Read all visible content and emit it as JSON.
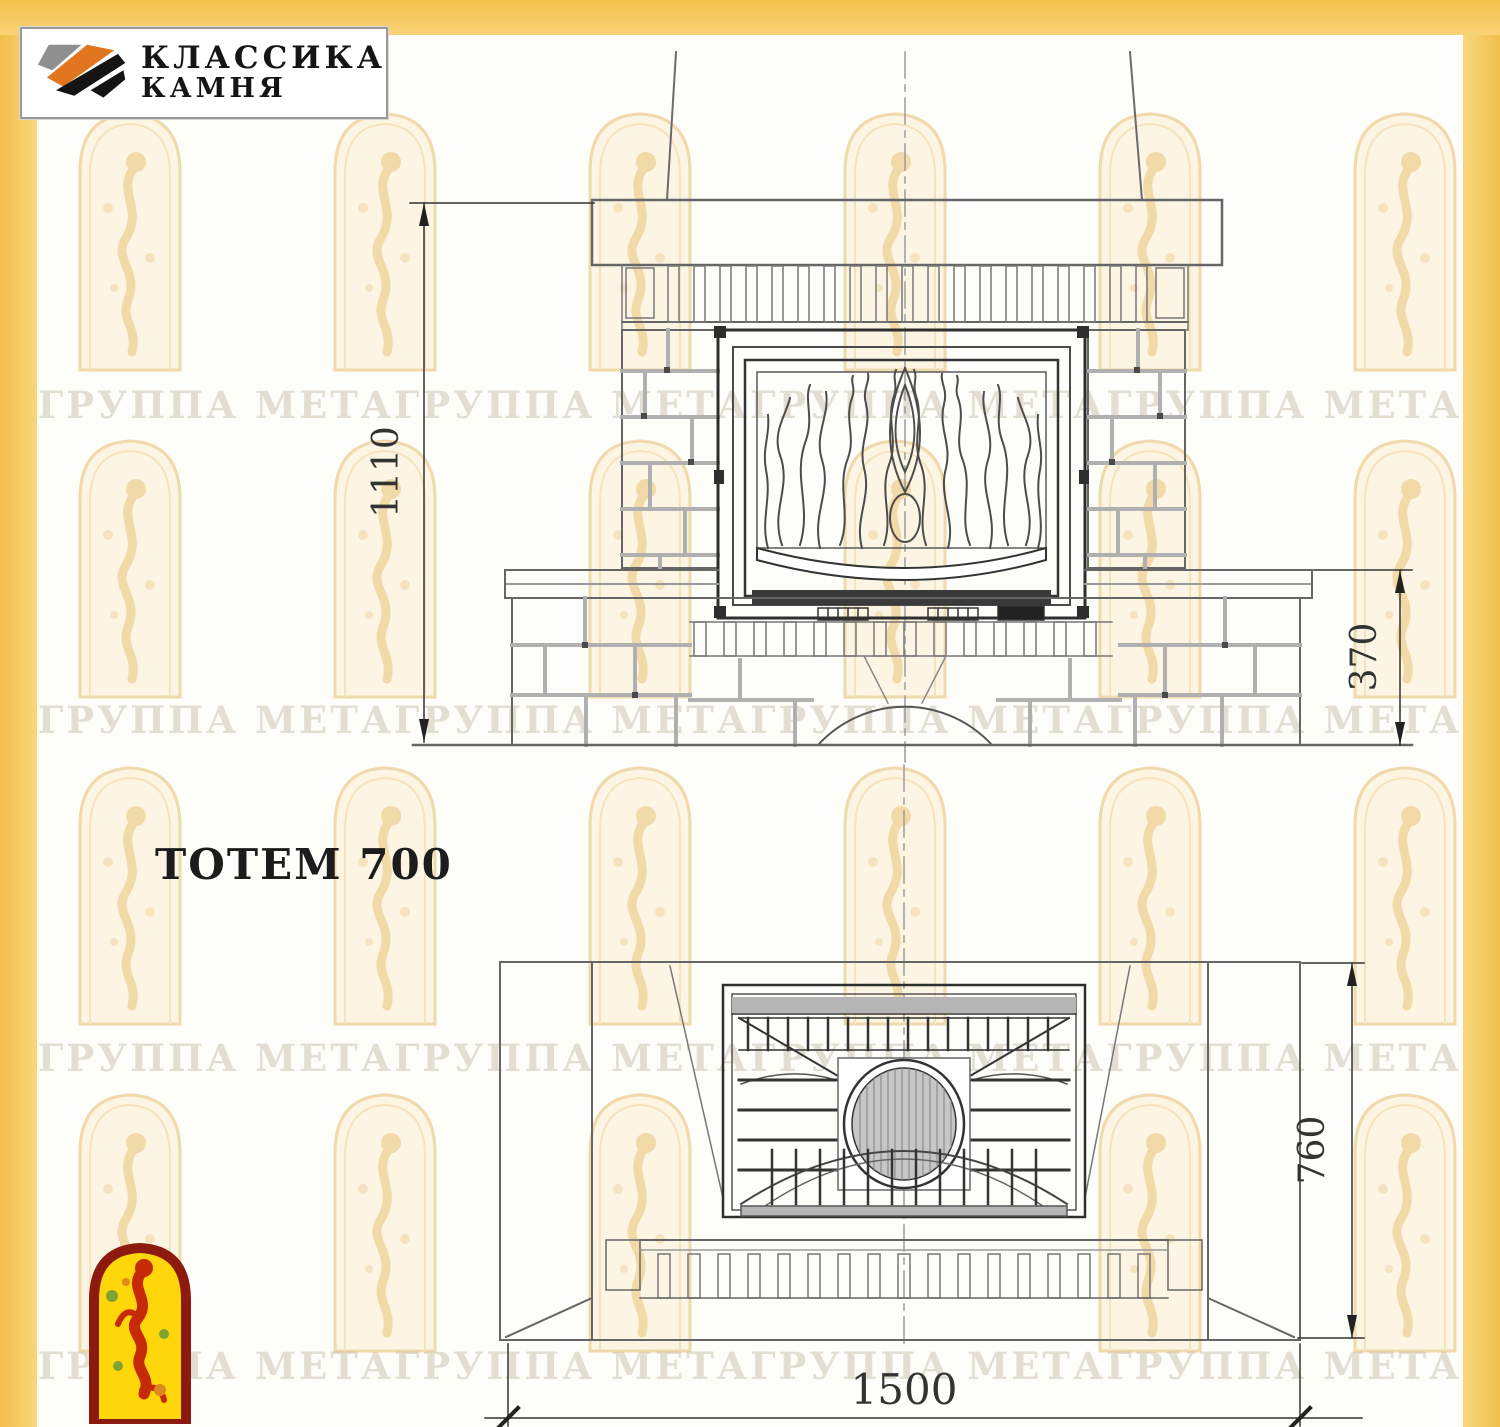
{
  "window": {
    "width": 1500,
    "height": 1427
  },
  "branding": {
    "logo_line1": "КЛАССИКА",
    "logo_line2": "КАМНЯ",
    "stripe_gray": "#8f8f8f",
    "stripe_orange": "#e2761f",
    "stripe_black": "#141414"
  },
  "title": "ТОТЕМ 700",
  "watermark": {
    "text": "ГРУППА МЕТАГРУППА МЕТАГРУППА МЕТАГРУППА МЕТА",
    "rows": 4,
    "tint": "#f3e3c2"
  },
  "frame": {
    "color": "#f5c75a"
  },
  "front_view": {
    "name": "front-elevation",
    "dim_height": "1110",
    "dim_plinth": "370"
  },
  "plan_view": {
    "name": "bottom-plan",
    "dim_depth": "760",
    "dim_width": "1500"
  },
  "emblem": {
    "fill": "#ffd60a",
    "border": "#8d1a0f",
    "figure": "#c62a08"
  }
}
